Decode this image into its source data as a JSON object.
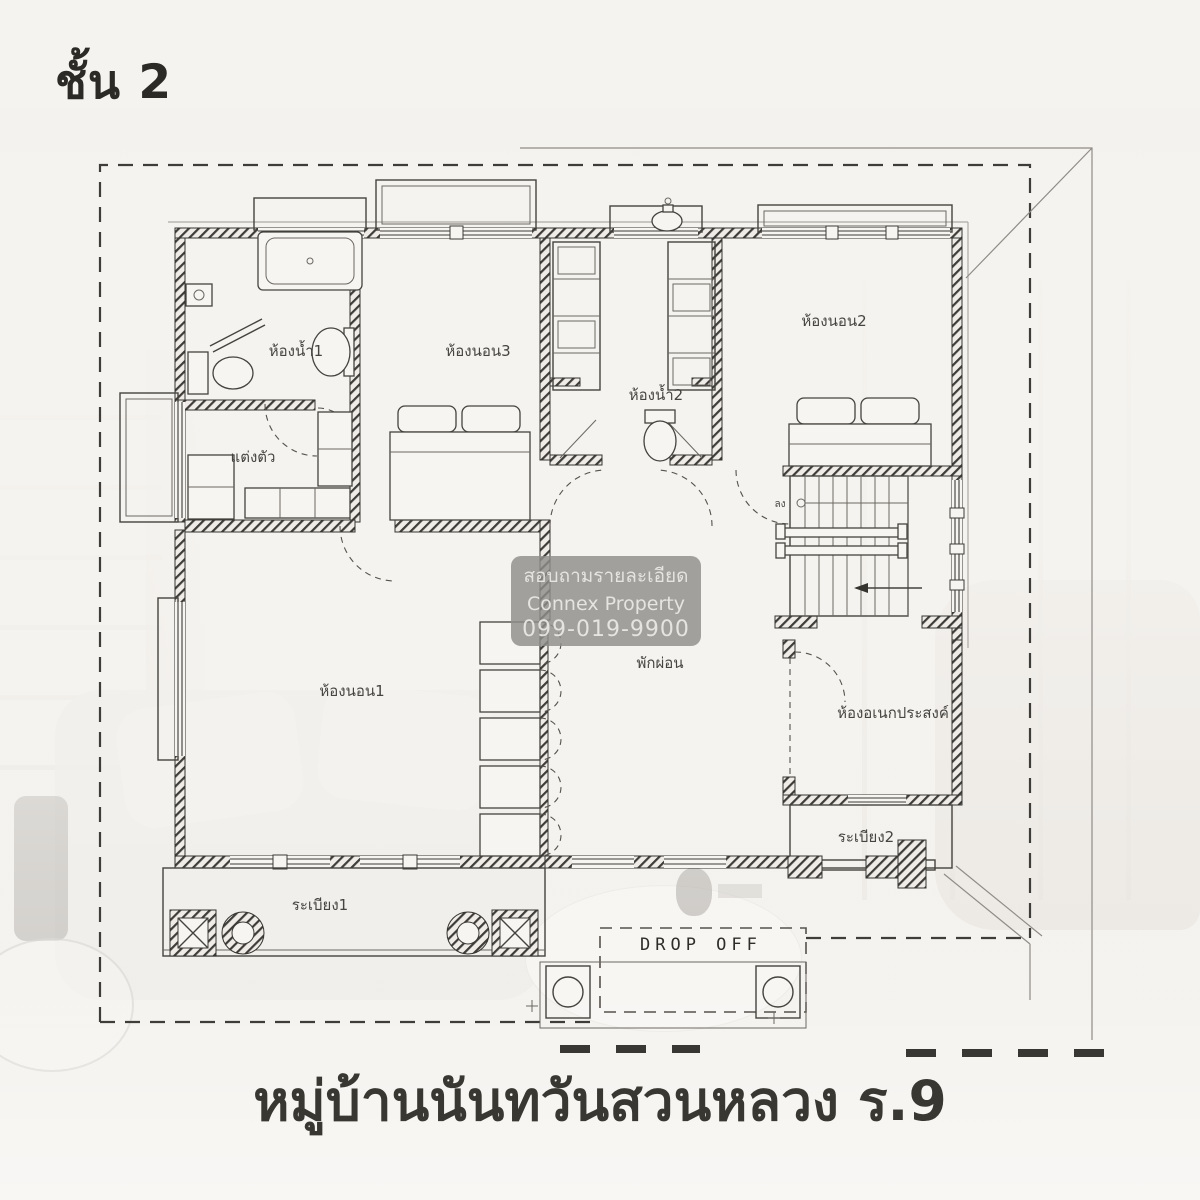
{
  "page": {
    "floor_label": "ชั้น 2",
    "project_title": "หมู่บ้านนันทวันสวนหลวง ร.9"
  },
  "watermark": {
    "line1": "สอบถามรายละเอียด",
    "line2": "Connex Property",
    "line3": "099-019-9900"
  },
  "floor_plan": {
    "rooms": [
      {
        "id": "bathroom-1",
        "label": "ห้องน้ำ1"
      },
      {
        "id": "bedroom-3",
        "label": "ห้องนอน3"
      },
      {
        "id": "bathroom-2",
        "label": "ห้องน้ำ2"
      },
      {
        "id": "bedroom-2",
        "label": "ห้องนอน2"
      },
      {
        "id": "dressing-room",
        "label": "แต่งตัว"
      },
      {
        "id": "bedroom-1",
        "label": "ห้องนอน1"
      },
      {
        "id": "living-area",
        "label": "พักผ่อน"
      },
      {
        "id": "multipurpose-room",
        "label": "ห้องอเนกประสงค์"
      },
      {
        "id": "balcony-1",
        "label": "ระเบียง1"
      },
      {
        "id": "balcony-2",
        "label": "ระเบียง2"
      }
    ],
    "stair_down_label": "ลง",
    "drop_off_label": "DROP OFF"
  },
  "colors": {
    "ink": "#36342f",
    "paper": "#f4f2ee",
    "watermark_bg": "#8f8d8a",
    "watermark_text": "#ebe9e6"
  }
}
